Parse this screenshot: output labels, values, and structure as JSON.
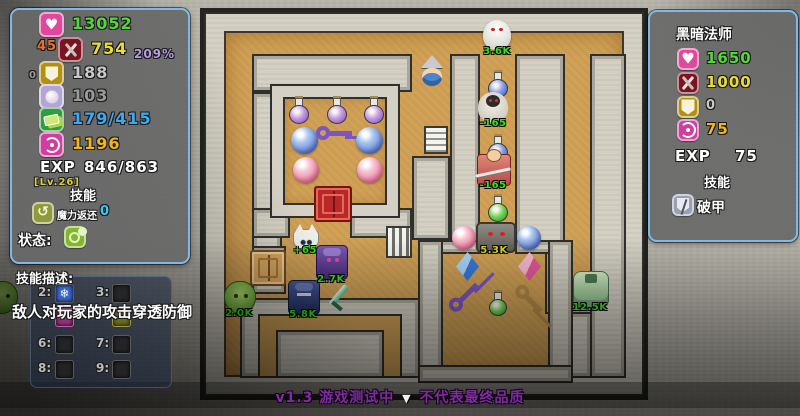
{
  "colors": {
    "panel_border": "#7cb8e8",
    "floor": "#d0a157",
    "wall": "#d4d1c4",
    "hp_green": "#52d836",
    "atk_yellow": "#e8dc3c",
    "def_gray": "#c9c9c9",
    "mdef_gray": "#9a9a9a",
    "gold_blue": "#3fa8f0",
    "spirit_orange": "#f2b425",
    "buff_orange": "#e87030",
    "percent_purple": "#b79ae2",
    "mana_cyan": "#38c8f0",
    "level_yellow": "#d8cf3e",
    "label_green": "#35e51c",
    "version_purple": "#7d2d9c"
  },
  "player_panel": {
    "rows": [
      {
        "icon": "heart-icon",
        "value": "13052"
      },
      {
        "icon": "attack-icon",
        "value": "754",
        "prefix": "45",
        "suffix": "209%"
      },
      {
        "icon": "shield-icon",
        "value": "188",
        "prefix": "0"
      },
      {
        "icon": "magic-orb-icon",
        "value": "103"
      },
      {
        "icon": "gold-icon",
        "value": "179/415"
      },
      {
        "icon": "spirit-icon",
        "value": "1196"
      }
    ],
    "exp_label": "EXP",
    "exp_value": "846/863",
    "level": "[Lv.26]",
    "skills_title": "技能",
    "mana_skill": {
      "label": "魔力返还",
      "value": "0"
    },
    "status_label": "状态:"
  },
  "enemy_panel": {
    "title": "黑暗法师",
    "rows": [
      {
        "icon": "heart-icon",
        "value": "1650"
      },
      {
        "icon": "attack-icon",
        "value": "1000"
      },
      {
        "icon": "shield-icon",
        "value": "0"
      },
      {
        "icon": "spirit-icon",
        "value": "75"
      }
    ],
    "exp_label": "EXP",
    "exp_value": "75",
    "skills_title": "技能",
    "skill_name": "破甲"
  },
  "skill_desc_panel": {
    "title": "技能描述:",
    "tooltip": "敌人对玩家的攻击穿透防御",
    "keys": [
      "2:",
      "3:",
      "6:",
      "7:",
      "8:",
      "9:"
    ]
  },
  "footer": {
    "version": "v1.3 游戏测试中",
    "caret": "▼",
    "note": "不代表最终品质"
  },
  "maze": {
    "entities": [
      {
        "name": "enemy-ghost-white",
        "type": "ghost-white",
        "x": 483,
        "y": 20,
        "w": 28,
        "h": 30,
        "label": "3.6K"
      },
      {
        "name": "player-witch",
        "type": "witch",
        "x": 418,
        "y": 56,
        "w": 28,
        "h": 34
      },
      {
        "name": "item-potion-blue-1",
        "type": "potion-blue",
        "x": 488,
        "y": 72,
        "w": 20,
        "h": 26
      },
      {
        "name": "enemy-ghost-dark",
        "type": "ghost-dark",
        "x": 478,
        "y": 92,
        "w": 30,
        "h": 30,
        "label": "-165"
      },
      {
        "name": "item-potion-blue-2",
        "type": "potion-blue",
        "x": 488,
        "y": 136,
        "w": 20,
        "h": 26
      },
      {
        "name": "enemy-warrior-red",
        "type": "warrior-red",
        "x": 477,
        "y": 154,
        "w": 32,
        "h": 30,
        "label": "-165"
      },
      {
        "name": "item-potion-green-1",
        "type": "potion-green",
        "x": 488,
        "y": 196,
        "w": 20,
        "h": 26
      },
      {
        "name": "stairs-upper",
        "type": "stairs-h",
        "x": 424,
        "y": 126,
        "w": 24,
        "h": 28
      },
      {
        "name": "stairs-lower",
        "type": "stairs-v",
        "x": 386,
        "y": 226,
        "w": 26,
        "h": 32
      },
      {
        "name": "item-potion-purple-1",
        "type": "potion-purple",
        "x": 289,
        "y": 98,
        "w": 20,
        "h": 26
      },
      {
        "name": "item-potion-purple-2",
        "type": "potion-purple",
        "x": 327,
        "y": 98,
        "w": 20,
        "h": 26
      },
      {
        "name": "item-potion-purple-3",
        "type": "potion-purple",
        "x": 364,
        "y": 98,
        "w": 20,
        "h": 26
      },
      {
        "name": "item-orb-blue-1",
        "type": "orb-blue",
        "x": 291,
        "y": 127,
        "w": 27,
        "h": 27
      },
      {
        "name": "item-key-purple",
        "type": "key-purple",
        "x": 316,
        "y": 121,
        "w": 38,
        "h": 26
      },
      {
        "name": "item-orb-blue-2",
        "type": "orb-blue",
        "x": 356,
        "y": 127,
        "w": 27,
        "h": 27
      },
      {
        "name": "item-orb-pink-1",
        "type": "orb-pink",
        "x": 293,
        "y": 157,
        "w": 26,
        "h": 26
      },
      {
        "name": "item-orb-pink-2",
        "type": "orb-pink",
        "x": 357,
        "y": 157,
        "w": 26,
        "h": 26
      },
      {
        "name": "gate-red",
        "type": "gate-red",
        "x": 314,
        "y": 186,
        "w": 38,
        "h": 36
      },
      {
        "name": "enemy-cat-white",
        "type": "cat-white",
        "x": 293,
        "y": 229,
        "w": 24,
        "h": 20,
        "label": "+65"
      },
      {
        "name": "enemy-knight-purple",
        "type": "knight-purple",
        "x": 316,
        "y": 245,
        "w": 30,
        "h": 33,
        "label": "2.7K"
      },
      {
        "name": "gate-tan",
        "type": "gate-tan",
        "x": 250,
        "y": 250,
        "w": 36,
        "h": 36
      },
      {
        "name": "enemy-slime-green",
        "type": "slime-green",
        "x": 224,
        "y": 281,
        "w": 30,
        "h": 31,
        "label": "2.0K"
      },
      {
        "name": "enemy-knight-blue",
        "type": "knight-blue",
        "x": 288,
        "y": 280,
        "w": 30,
        "h": 33,
        "label": "5.8K"
      },
      {
        "name": "item-sword-green",
        "type": "sword-green",
        "x": 324,
        "y": 283,
        "w": 24,
        "h": 27
      },
      {
        "name": "enemy-golem-stone",
        "type": "golem-stone",
        "x": 476,
        "y": 222,
        "w": 36,
        "h": 27,
        "label": "5.3K",
        "label_color": "#d8d332"
      },
      {
        "name": "item-orb-pink-3",
        "type": "orb-pink",
        "x": 452,
        "y": 226,
        "w": 24,
        "h": 24
      },
      {
        "name": "item-orb-blue-3",
        "type": "orb-blue",
        "x": 517,
        "y": 226,
        "w": 24,
        "h": 24
      },
      {
        "name": "item-crystal-blue",
        "type": "crystal-blue",
        "x": 456,
        "y": 252,
        "w": 23,
        "h": 29
      },
      {
        "name": "item-crystal-pink",
        "type": "crystal-pink",
        "x": 518,
        "y": 252,
        "w": 23,
        "h": 29
      },
      {
        "name": "item-key-purple-diag",
        "type": "key-purple-diag",
        "x": 447,
        "y": 284,
        "w": 32,
        "h": 30
      },
      {
        "name": "item-key-bronze-diag",
        "type": "key-bronze-diag",
        "x": 512,
        "y": 285,
        "w": 32,
        "h": 28
      },
      {
        "name": "item-potion-green-2",
        "type": "potion-green",
        "x": 489,
        "y": 292,
        "w": 18,
        "h": 24
      },
      {
        "name": "enemy-golem-green",
        "type": "golem-green",
        "x": 573,
        "y": 271,
        "w": 34,
        "h": 35,
        "label": "12.5K"
      },
      {
        "name": "enemy-slime-edge",
        "type": "slime-green",
        "x": -14,
        "y": 281,
        "w": 30,
        "h": 31
      }
    ]
  }
}
